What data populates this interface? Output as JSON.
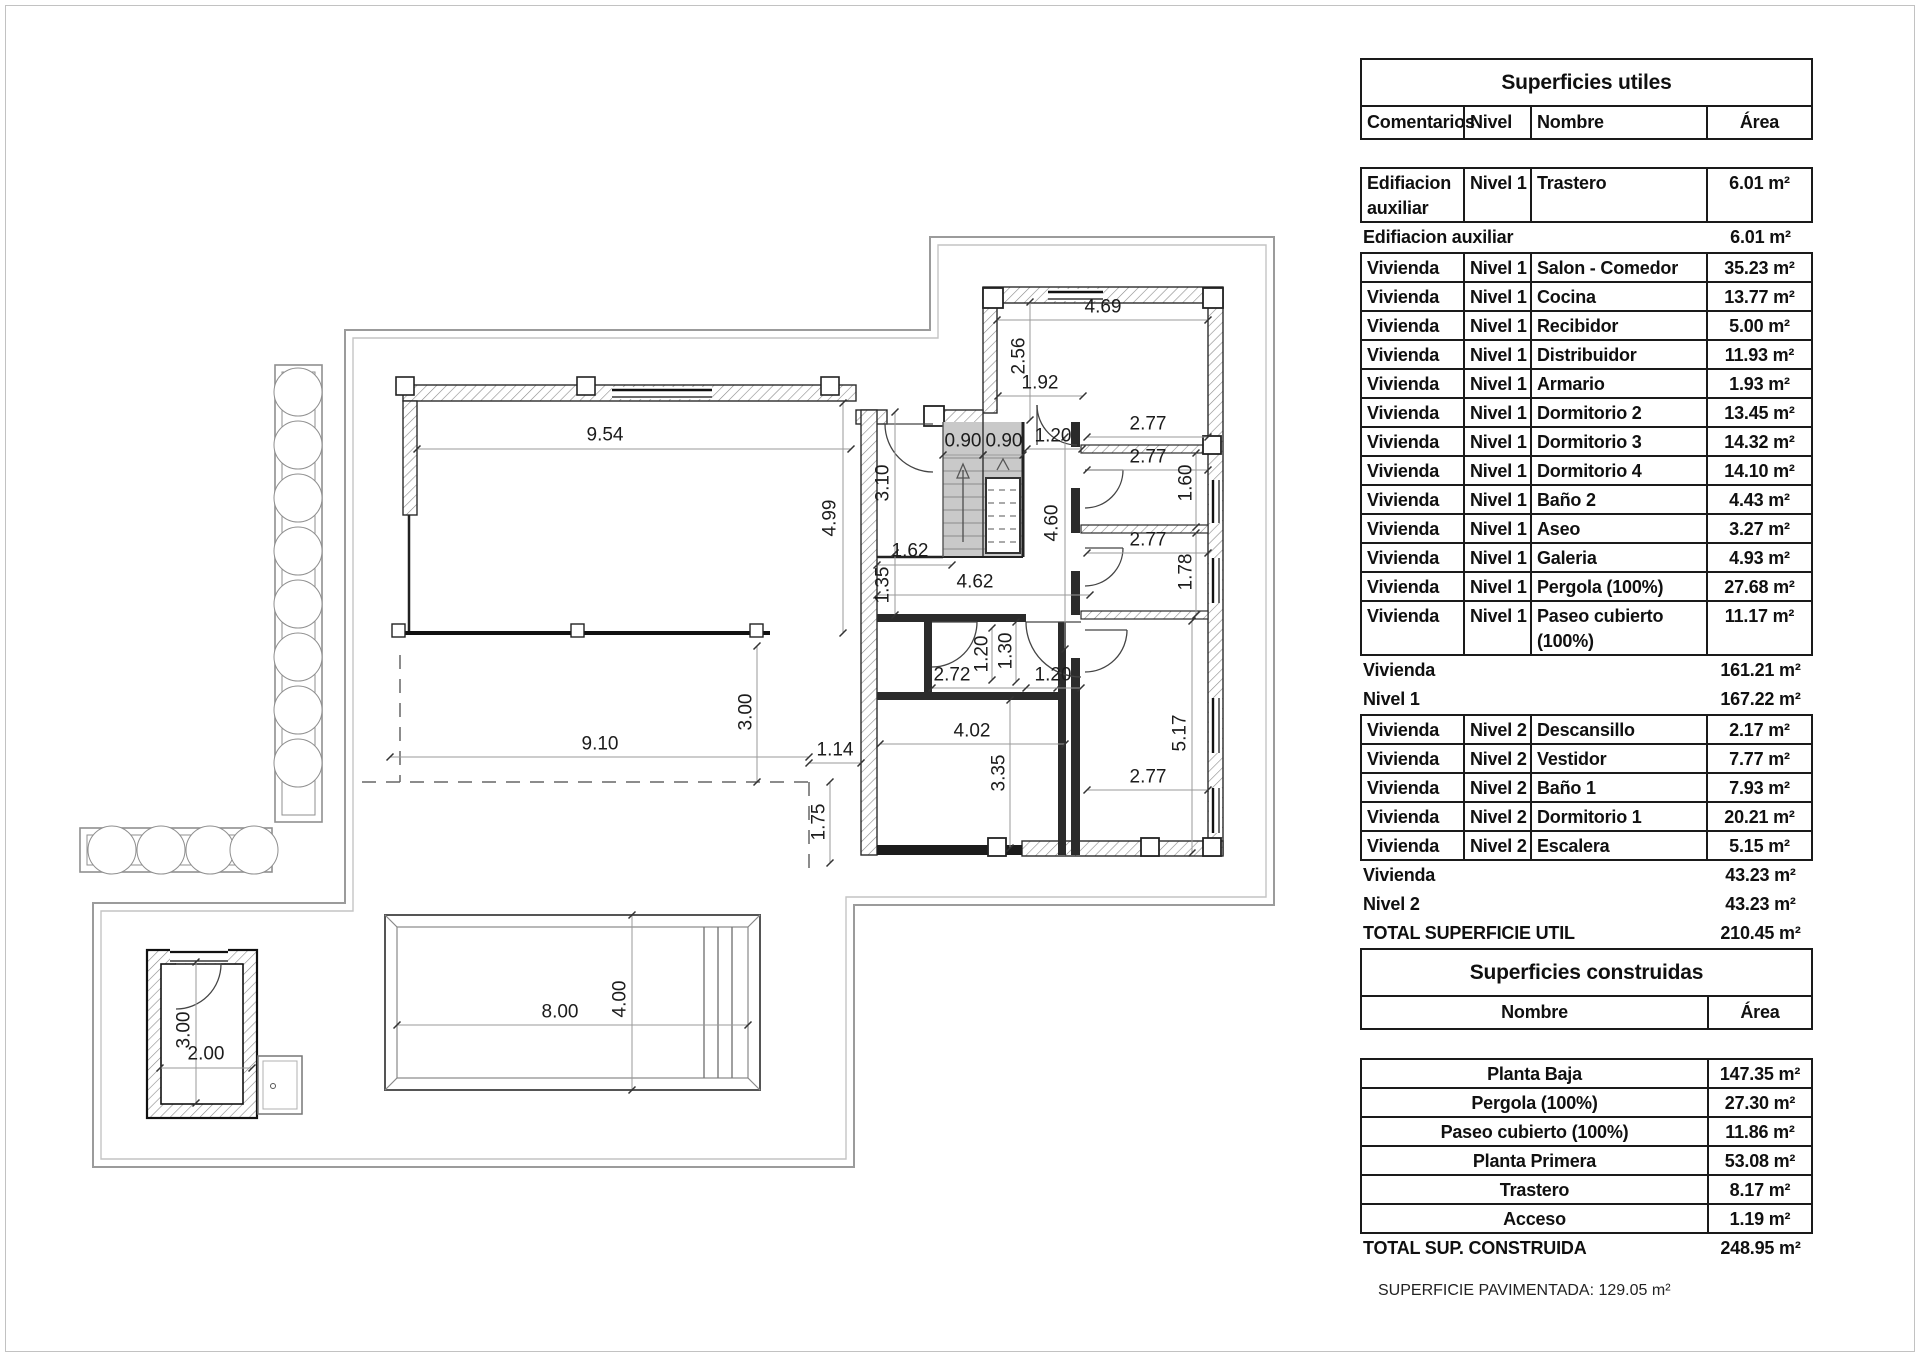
{
  "plan": {
    "dim_labels": [
      {
        "t": "9.54",
        "x": 605,
        "y": 435,
        "r": 0
      },
      {
        "t": "4.99",
        "x": 830,
        "y": 518,
        "r": -90
      },
      {
        "t": "3.10",
        "x": 883,
        "y": 483,
        "r": -90
      },
      {
        "t": "1.62",
        "x": 910,
        "y": 551,
        "r": 0
      },
      {
        "t": "1.35",
        "x": 883,
        "y": 585,
        "r": -90
      },
      {
        "t": "4.62",
        "x": 975,
        "y": 582,
        "r": 0
      },
      {
        "t": "0.90",
        "x": 963,
        "y": 441,
        "r": 0
      },
      {
        "t": "0.90",
        "x": 1004,
        "y": 441,
        "r": 0
      },
      {
        "t": "1.20",
        "x": 1053,
        "y": 436,
        "r": 0
      },
      {
        "t": "2.56",
        "x": 1019,
        "y": 356,
        "r": -90
      },
      {
        "t": "1.92",
        "x": 1040,
        "y": 383,
        "r": 0
      },
      {
        "t": "4.69",
        "x": 1103,
        "y": 307,
        "r": 0
      },
      {
        "t": "2.77",
        "x": 1148,
        "y": 424,
        "r": 0
      },
      {
        "t": "2.77",
        "x": 1148,
        "y": 457,
        "r": 0
      },
      {
        "t": "1.60",
        "x": 1186,
        "y": 483,
        "r": -90
      },
      {
        "t": "4.60",
        "x": 1052,
        "y": 523,
        "r": -90
      },
      {
        "t": "2.77",
        "x": 1148,
        "y": 540,
        "r": 0
      },
      {
        "t": "1.78",
        "x": 1186,
        "y": 572,
        "r": -90
      },
      {
        "t": "2.77",
        "x": 1148,
        "y": 777,
        "r": 0
      },
      {
        "t": "5.17",
        "x": 1180,
        "y": 733,
        "r": -90
      },
      {
        "t": "2.72",
        "x": 952,
        "y": 675,
        "r": 0
      },
      {
        "t": "1.20",
        "x": 982,
        "y": 654,
        "r": -90
      },
      {
        "t": "1.30",
        "x": 1006,
        "y": 651,
        "r": -90
      },
      {
        "t": "1.20",
        "x": 1053,
        "y": 675,
        "r": 0
      },
      {
        "t": "3.00",
        "x": 746,
        "y": 712,
        "r": -90
      },
      {
        "t": "4.02",
        "x": 972,
        "y": 731,
        "r": 0
      },
      {
        "t": "3.35",
        "x": 999,
        "y": 773,
        "r": -90
      },
      {
        "t": "1.14",
        "x": 835,
        "y": 750,
        "r": 0
      },
      {
        "t": "1.75",
        "x": 819,
        "y": 822,
        "r": -90
      },
      {
        "t": "9.10",
        "x": 600,
        "y": 744,
        "r": 0
      },
      {
        "t": "8.00",
        "x": 560,
        "y": 1012,
        "r": 0
      },
      {
        "t": "4.00",
        "x": 620,
        "y": 999,
        "r": -90
      },
      {
        "t": "3.00",
        "x": 184,
        "y": 1030,
        "r": -90
      },
      {
        "t": "2.00",
        "x": 206,
        "y": 1054,
        "r": 0
      }
    ]
  },
  "surfaces_utiles": {
    "title": "Superficies utiles",
    "columns": [
      "Comentarios",
      "Nivel",
      "Nombre",
      "Área"
    ],
    "items": [
      {
        "type": "group",
        "rows": [
          [
            "Edifiacion auxiliar",
            "Nivel 1",
            "Trastero",
            "6.01 m²"
          ]
        ],
        "tall": true
      },
      {
        "type": "subtotal",
        "label": "Edifiacion auxiliar",
        "value": "6.01 m²"
      },
      {
        "type": "group",
        "rows": [
          [
            "Vivienda",
            "Nivel 1",
            "Salon - Comedor",
            "35.23 m²"
          ],
          [
            "Vivienda",
            "Nivel 1",
            "Cocina",
            "13.77 m²"
          ],
          [
            "Vivienda",
            "Nivel 1",
            "Recibidor",
            "5.00 m²"
          ],
          [
            "Vivienda",
            "Nivel 1",
            "Distribuidor",
            "11.93 m²"
          ],
          [
            "Vivienda",
            "Nivel 1",
            "Armario",
            "1.93 m²"
          ],
          [
            "Vivienda",
            "Nivel 1",
            "Dormitorio 2",
            "13.45 m²"
          ],
          [
            "Vivienda",
            "Nivel 1",
            "Dormitorio 3",
            "14.32 m²"
          ],
          [
            "Vivienda",
            "Nivel 1",
            "Dormitorio 4",
            "14.10 m²"
          ],
          [
            "Vivienda",
            "Nivel 1",
            "Baño 2",
            "4.43 m²"
          ],
          [
            "Vivienda",
            "Nivel 1",
            "Aseo",
            "3.27 m²"
          ],
          [
            "Vivienda",
            "Nivel 1",
            "Galeria",
            "4.93 m²"
          ],
          [
            "Vivienda",
            "Nivel 1",
            "Pergola (100%)",
            "27.68 m²"
          ],
          [
            "Vivienda",
            "Nivel 1",
            "Paseo cubierto (100%)",
            "11.17 m²"
          ]
        ]
      },
      {
        "type": "subtotal",
        "label": "Vivienda",
        "value": "161.21 m²"
      },
      {
        "type": "subtotal",
        "label": "Nivel 1",
        "value": "167.22 m²"
      },
      {
        "type": "group",
        "rows": [
          [
            "Vivienda",
            "Nivel 2",
            "Descansillo",
            "2.17 m²"
          ],
          [
            "Vivienda",
            "Nivel 2",
            "Vestidor",
            "7.77 m²"
          ],
          [
            "Vivienda",
            "Nivel 2",
            "Baño 1",
            "7.93 m²"
          ],
          [
            "Vivienda",
            "Nivel 2",
            "Dormitorio 1",
            "20.21 m²"
          ],
          [
            "Vivienda",
            "Nivel 2",
            "Escalera",
            "5.15 m²"
          ]
        ]
      },
      {
        "type": "subtotal",
        "label": "Vivienda",
        "value": "43.23 m²"
      },
      {
        "type": "subtotal",
        "label": "Nivel 2",
        "value": "43.23 m²"
      },
      {
        "type": "subtotal",
        "label": "TOTAL SUPERFICIE UTIL",
        "value": "210.45 m²"
      }
    ]
  },
  "surfaces_construidas": {
    "title": "Superficies construidas",
    "columns": [
      "Nombre",
      "Área"
    ],
    "items": [
      {
        "type": "group",
        "rows": [
          [
            "Planta Baja",
            "147.35 m²"
          ],
          [
            "Pergola (100%)",
            "27.30 m²"
          ],
          [
            "Paseo cubierto (100%)",
            "11.86 m²"
          ],
          [
            "Planta Primera",
            "53.08 m²"
          ],
          [
            "Trastero",
            "8.17 m²"
          ],
          [
            "Acceso",
            "1.19 m²"
          ]
        ]
      },
      {
        "type": "subtotal",
        "label": "TOTAL SUP. CONSTRUIDA",
        "value": "248.95 m²"
      }
    ]
  },
  "footer_note": "SUPERFICIE PAVIMENTADA: 129.05 m²"
}
